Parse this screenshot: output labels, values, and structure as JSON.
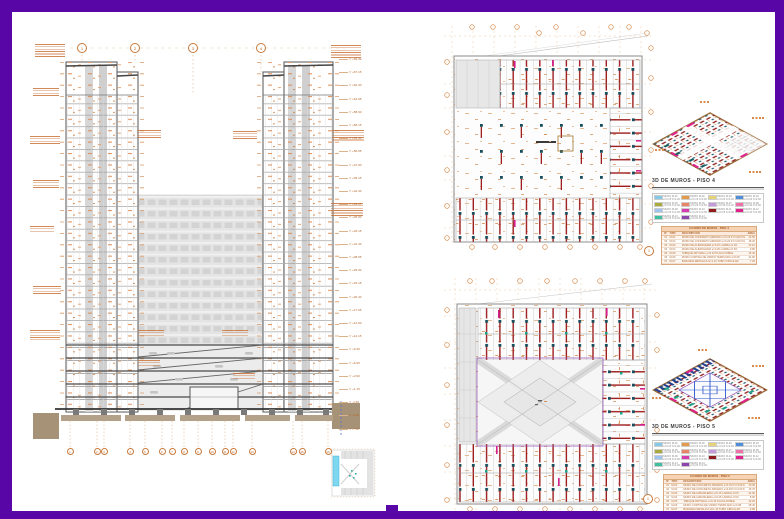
{
  "sheet": {
    "frame_color": "#5806a6"
  },
  "axon_top": {
    "title": "3D DE MUROS - PISO 4"
  },
  "axon_bottom": {
    "title": "3D DE MUROS - PISO 5"
  },
  "legend": {
    "items": [
      {
        "color": "#86c9e6",
        "label": "MURO M-01",
        "sub": "e=0.15 h=2.40"
      },
      {
        "color": "#e39a4b",
        "label": "MURO M-02",
        "sub": "e=0.15 h=2.60"
      },
      {
        "color": "#e6d27a",
        "label": "MURO M-03",
        "sub": "e=0.20 h=2.40"
      },
      {
        "color": "#4f8fd9",
        "label": "MURO M-04",
        "sub": "e=0.20 h=2.60"
      },
      {
        "color": "#a9a93c",
        "label": "MURO M-05",
        "sub": "e=0.25 h=2.40"
      },
      {
        "color": "#e98565",
        "label": "MURO M-06",
        "sub": "e=0.25 h=2.60"
      },
      {
        "color": "#c49ad9",
        "label": "MURO M-07",
        "sub": "e=0.30 h=2.40"
      },
      {
        "color": "#ef6fa8",
        "label": "MURO M-08",
        "sub": "e=0.30 h=2.60"
      },
      {
        "color": "#9fc4ef",
        "label": "MURO M-09",
        "sub": "e=0.15 h=3.00"
      },
      {
        "color": "#d63bb0",
        "label": "MURO M-10",
        "sub": "e=0.20 h=3.00"
      },
      {
        "color": "#8e1c1c",
        "label": "MURO M-11",
        "sub": "e=0.25 h=3.00"
      },
      {
        "color": "#e0218a",
        "label": "MURO M-12",
        "sub": "e=0.30 h=3.00"
      },
      {
        "color": "#3fbf9f",
        "label": "MURO M-13",
        "sub": "e=0.15 h=3.20"
      },
      {
        "color": "#8e44ad",
        "label": "MURO M-14",
        "sub": "e=0.20 h=3.20"
      }
    ]
  },
  "table_top": {
    "title": "CUADRO DE MUROS - PISO 4",
    "columns": [
      "N°",
      "TIPO",
      "DESCRIPCIÓN",
      "ÁREA"
    ],
    "rows": [
      [
        "01",
        "M-01",
        "MURO DE CONCRETO ARMADO e=0.15 F'C=210 KG/CM2",
        "12.50"
      ],
      [
        "02",
        "M-02",
        "MURO DE CONCRETO ARMADO e=0.20 F'C=210 KG/CM2",
        "18.20"
      ],
      [
        "03",
        "M-03",
        "MURO DE ALBAÑILERIA e=0.15 LADRILLO KK",
        "22.10"
      ],
      [
        "04",
        "M-04",
        "MURO DE ALBAÑILERIA e=0.25 LADRILLO KK",
        "9.80"
      ],
      [
        "05",
        "M-05",
        "TABIQUE DRYWALL e=0.10 PLACA DOBLE",
        "15.40"
      ],
      [
        "06",
        "M-06",
        "MURO CORTINA DE VIDRIO TEMPLADO e=0.08",
        "31.60"
      ],
      [
        "07",
        "M-07",
        "BARANDA METALICA H=1.10 TUBO CIRCULAR",
        "7.25"
      ]
    ]
  },
  "table_bottom": {
    "title": "CUADRO DE MUROS - PISO 5",
    "columns": [
      "N°",
      "TIPO",
      "DESCRIPCIÓN",
      "ÁREA"
    ],
    "rows": [
      [
        "01",
        "M-01",
        "MURO DE CONCRETO ARMADO e=0.15 F'C=210 KG/CM2",
        "10.30"
      ],
      [
        "02",
        "M-02",
        "MURO DE CONCRETO ARMADO e=0.20 F'C=210 KG/CM2",
        "16.75"
      ],
      [
        "03",
        "M-03",
        "MURO DE ALBAÑILERIA e=0.15 LADRILLO KK",
        "24.60"
      ],
      [
        "04",
        "M-04",
        "MURO DE ALBAÑILERIA e=0.25 LADRILLO KK",
        "8.90"
      ],
      [
        "05",
        "M-05",
        "TABIQUE DRYWALL e=0.10 PLACA DOBLE",
        "13.20"
      ],
      [
        "06",
        "M-06",
        "MURO CORTINA DE VIDRIO TEMPLADO e=0.08",
        "28.40"
      ],
      [
        "07",
        "M-07",
        "BARANDA METALICA H=1.10 TUBO CIRCULAR",
        "6.80"
      ]
    ]
  },
  "section": {
    "grid_top": [
      "1",
      "2",
      "3",
      "4"
    ],
    "grid_bottom": [
      "1",
      "2",
      "3",
      "4",
      "5",
      "6",
      "7",
      "8",
      "9",
      "10",
      "11",
      "12",
      "13",
      "14",
      "15",
      "16"
    ],
    "levels": [
      "+69.90",
      "+67.15",
      "+64.40",
      "+61.65",
      "+58.90",
      "+56.15",
      "+53.40",
      "+50.65",
      "+47.90",
      "+45.15",
      "+42.40",
      "+39.65",
      "+36.90",
      "+34.15",
      "+31.40",
      "+28.65",
      "+25.90",
      "+23.15",
      "+20.40",
      "+17.65",
      "+14.90",
      "+12.15",
      "+9.40",
      "+6.65",
      "+3.90",
      "+1.15",
      "-1.60",
      "-4.35",
      "-7.10"
    ],
    "circle_markers": [
      "1",
      "1"
    ]
  }
}
